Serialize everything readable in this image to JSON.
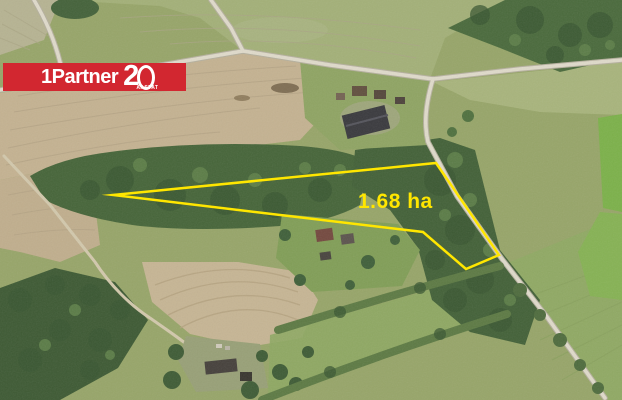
{
  "logo": {
    "brand_text": "1Partner",
    "anniversary_digit": "2",
    "anniversary_suffix": "AASTAT",
    "background_color": "#d22730",
    "text_color": "#ffffff"
  },
  "parcel": {
    "area_label": "1.68 ha",
    "outline_color": "#ffe600",
    "points": "113,195 436,163 499,255 466,269 423,232"
  }
}
